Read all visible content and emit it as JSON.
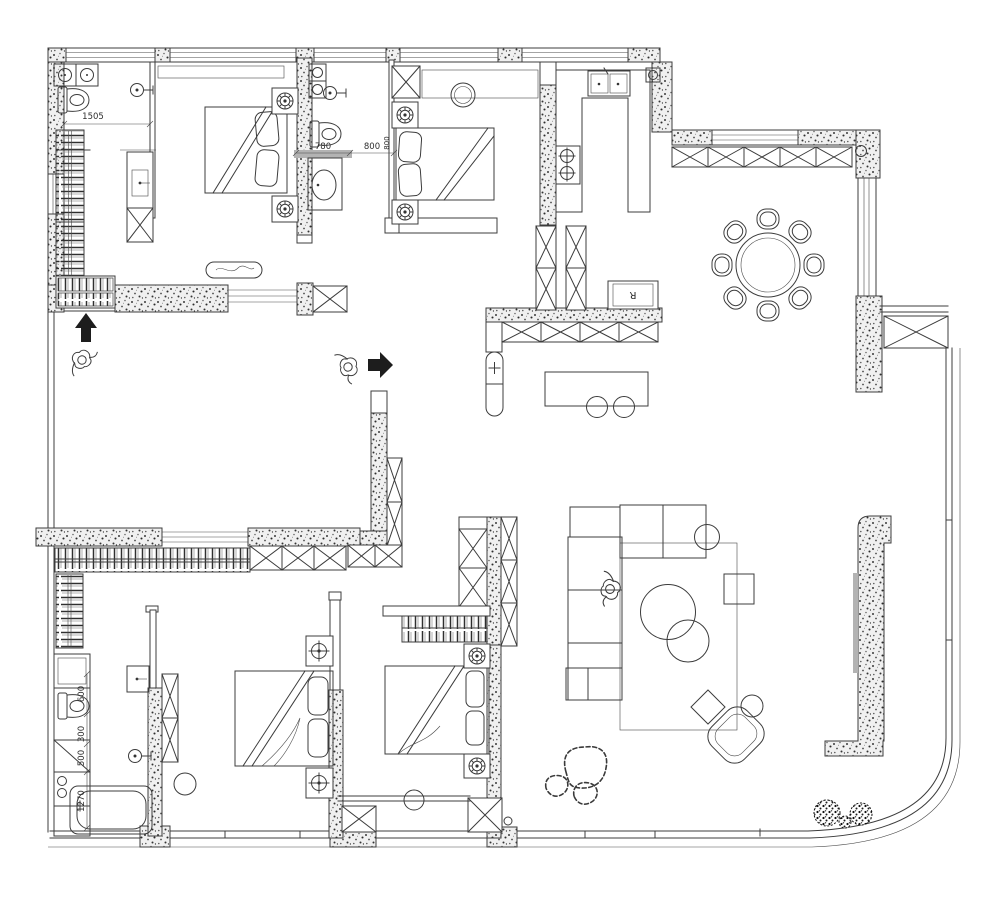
{
  "plan": {
    "type": "residential-apartment-floor-plan",
    "colors": {
      "line": "#3c3c3c",
      "wall_texture_base": "#efefef",
      "counter_gray": "#b3b3b3",
      "arrow_black": "#1d1d1d",
      "paper": "#ffffff"
    },
    "dimensions": {
      "bath1": {
        "text": "1505"
      },
      "bath2": {
        "text": "780"
      },
      "bed2_door": {
        "text": "800"
      },
      "bed2_door_v": {
        "text": "800"
      },
      "bath3_toilet": {
        "text": "600"
      },
      "bath3_a": {
        "text": "300"
      },
      "bath3_b": {
        "text": "500"
      },
      "bath3_tub": {
        "text": "1270"
      }
    },
    "labels": {
      "refrigerator": {
        "text": "R"
      }
    }
  }
}
